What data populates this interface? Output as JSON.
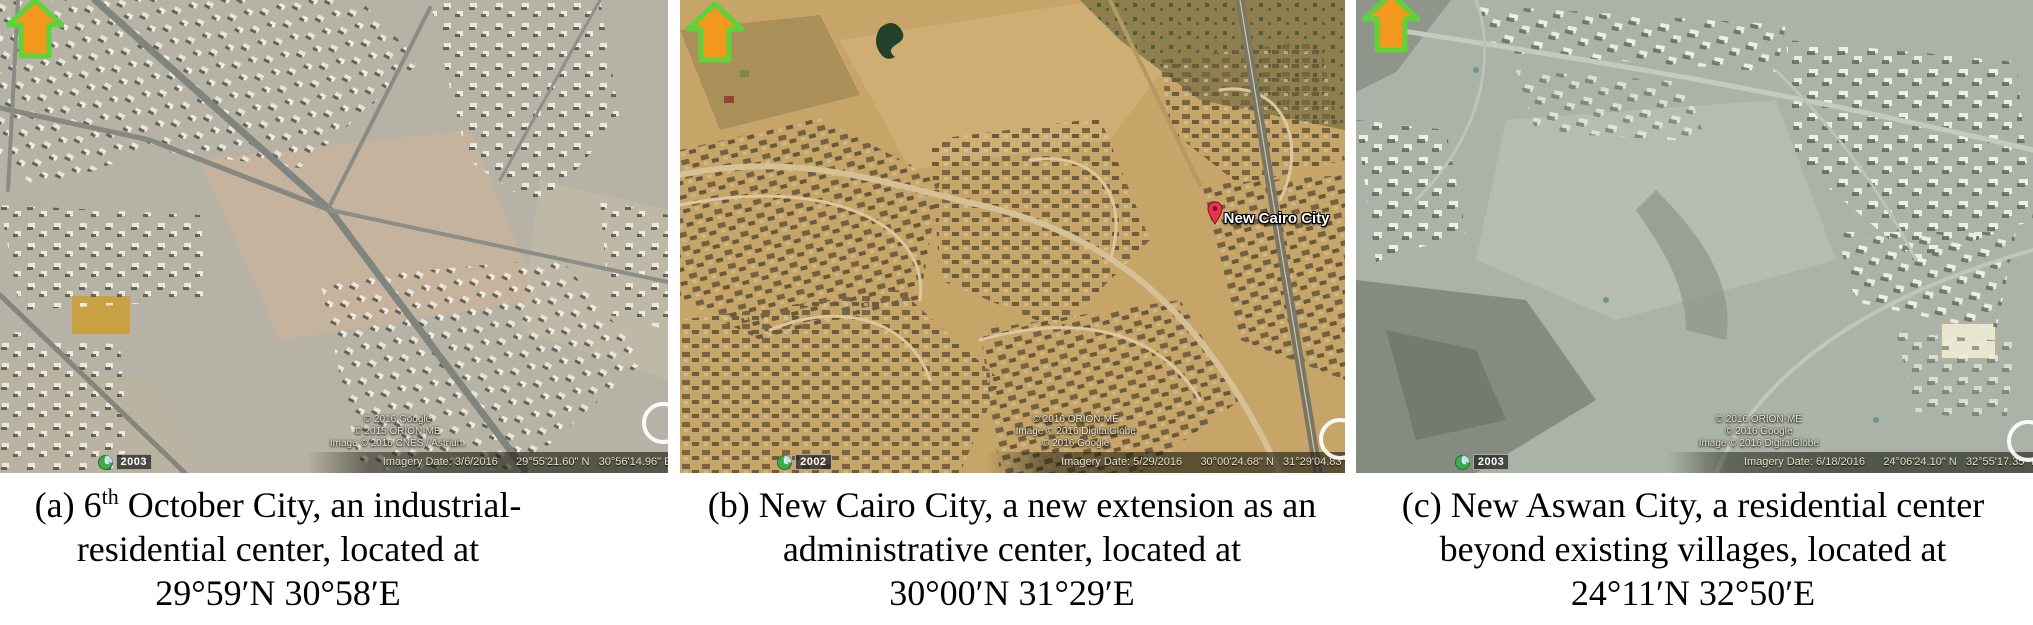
{
  "colors": {
    "arrow_fill": "#F2981C",
    "arrow_outline": "#5CD33B",
    "pin": "#E8354D",
    "caption_text": "#000000"
  },
  "panels": {
    "a": {
      "year": "2003",
      "credits": [
        "© 2016 Google",
        "© 2015 ORION-ME",
        "Image © 2016 CNES / Astrium"
      ],
      "status": "Imagery Date: 3/6/2016      29°55'21.60\" N   30°56'14.96\" E  elev   1"
    },
    "b": {
      "year": "2002",
      "credits": [
        "© 2016 ORION-ME",
        "Image © 2016 DigitalGlobe",
        "© 2016 Google"
      ],
      "status": "Imagery Date: 5/29/2016      30°00'24.68\" N   31°29'04.83\" E  elev   3",
      "placemark_label": "New Cairo City"
    },
    "c": {
      "year": "2003",
      "credits": [
        "© 2016 ORION-ME",
        "© 2016 Google",
        "Image © 2016 DigitalGlobe"
      ],
      "status": "Imagery Date: 6/18/2016      24°06'24.10\" N   32°55'17.35\" E  elev   168"
    }
  },
  "captions": {
    "a": {
      "line1_pre": "(a) 6",
      "line1_sup": "th",
      "line1_post": " October City, an industrial-",
      "line2": "residential center, located at",
      "line3": "29°59′N 30°58′E"
    },
    "b": {
      "line1": "(b) New Cairo City, a new extension as an",
      "line2": "administrative center, located at",
      "line3": "30°00′N 31°29′E"
    },
    "c": {
      "line1": "(c) New Aswan City, a residential center",
      "line2": "beyond existing villages, located at",
      "line3": "24°11′N 32°50′E"
    }
  }
}
